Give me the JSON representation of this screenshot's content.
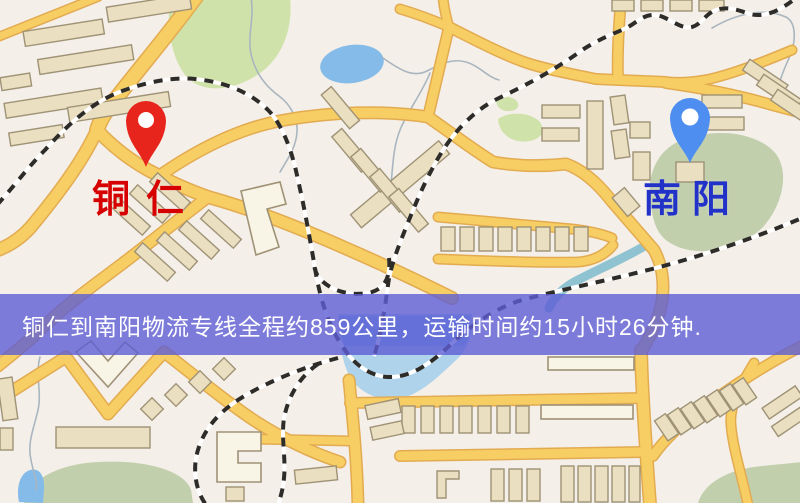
{
  "colors": {
    "map-bg": "#f4efe8",
    "road-fill": "#f7ce63",
    "road-casing": "#e3ab51",
    "bldg-fill": "#eadfc0",
    "bldg-stroke": "#9f9276",
    "bldg-light": "#f8f4e6",
    "park-bright": "#cfe2a9",
    "park-muted": "#c2cfad",
    "water-blue": "#85bbe8",
    "water-light": "#aed3ea",
    "river-teal": "#8fc3d2",
    "stream-grey": "#a9b6c0",
    "rail-black": "#2e2c28",
    "banner-bg": "rgba(94,94,213,0.8)",
    "banner-text": "#ffffff",
    "pin-red": "#e8251d",
    "label-red": "#d60000",
    "pin-blue": "#4d8ef0",
    "label-blue": "#2232c8"
  },
  "markers": {
    "origin": {
      "label": "铜仁"
    },
    "destination": {
      "label": "南阳"
    }
  },
  "banner": {
    "text": "铜仁到南阳物流专线全程约859公里，运输时间约15小时26分钟."
  }
}
